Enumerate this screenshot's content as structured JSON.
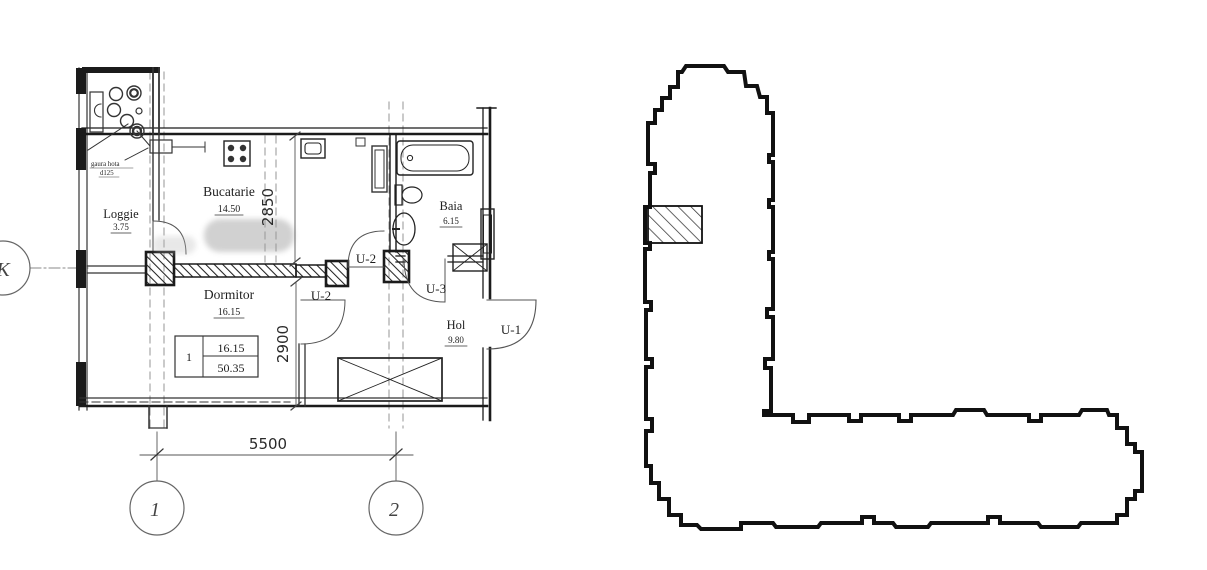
{
  "plan": {
    "rooms": {
      "bucatarie": {
        "name": "Bucatarie",
        "area": "14.50"
      },
      "loggie": {
        "name": "Loggie",
        "area": "3.75"
      },
      "baia": {
        "name": "Baia",
        "area": "6.15"
      },
      "dormitor": {
        "name": "Dormitor",
        "area": "16.15"
      },
      "hol": {
        "name": "Hol",
        "area": "9.80"
      }
    },
    "doors": {
      "u1": "U-1",
      "u2": "U-2",
      "u3": "U-3"
    },
    "dims": {
      "width": "5500",
      "kitchen_depth": "2850",
      "bedroom_depth": "2900"
    },
    "axes": {
      "k": "K",
      "one": "1",
      "two": "2"
    },
    "note": {
      "line1": "gaura hota",
      "line2": "d125"
    },
    "table": {
      "num": "1",
      "room_area": "16.15",
      "total_area": "50.35"
    }
  },
  "colors": {
    "line": "#1b1b1b",
    "dim_line": "#555555",
    "hatch": "#222222"
  }
}
